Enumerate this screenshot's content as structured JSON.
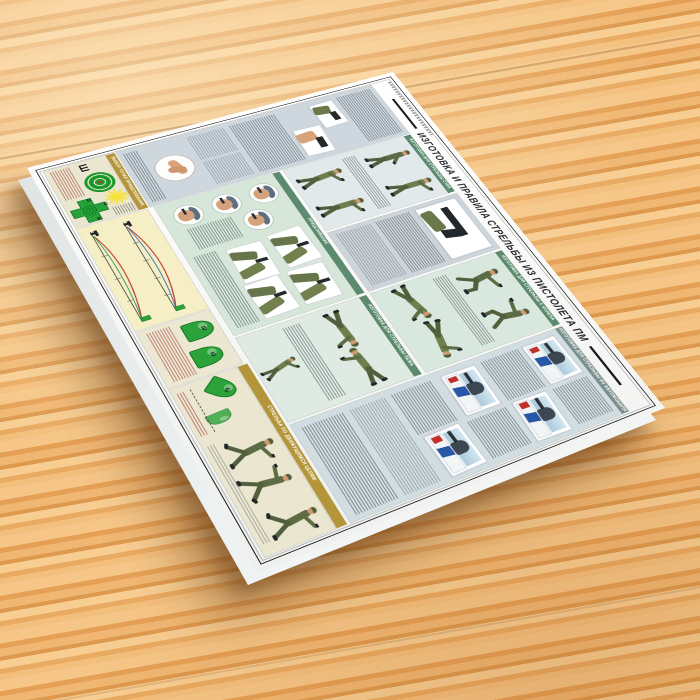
{
  "poster": {
    "title": "ИЗГОТОВКА И ПРАВИЛА СТРЕЛЬБЫ ИЗ ПИСТОЛЕТА ПМ",
    "sight_glyph": "Ш",
    "sections": {
      "standing": "ИЗГОТОВКА ДЛЯ СТРЕЛЬБЫ СТОЯ",
      "kneeling": "ИЗГОТОВКА ДЛЯ СТРЕЛЬБЫ С КОЛЕНА",
      "prone": "ИЗГОТОВКА ДЛЯ СТРЕЛЬБЫ ЛЕЖА",
      "car": "ИЗГОТОВКА ДЛЯ СТРЕЛЬБЫ ИЗ АВТОМОБИЛЯ",
      "aiming": "ПРИЦЕЛИВАНИЕ",
      "aim_point": "ВЫБОР ТОЧКИ ПРИЦЕЛИВАНИЯ",
      "moving": "СТРЕЛЬБА ПО ДВИЖУЩИМСЯ ЦЕЛЯМ"
    },
    "colors": {
      "wood": "#eaa963",
      "sheet": "#f8f9f8",
      "panel_gray": "#cdd7dd",
      "panel_green": "#d6e7da",
      "panel_blue": "#e2e9ea",
      "panel_beige": "#eae6d0",
      "panel_yellow": "#f6efc6",
      "strip_green": "#5c8a6e",
      "strip_gold": "#b5953a",
      "target_green": "#27a23a",
      "car_stripe_blue": "#2857a8",
      "patch_red": "#c03028"
    }
  }
}
